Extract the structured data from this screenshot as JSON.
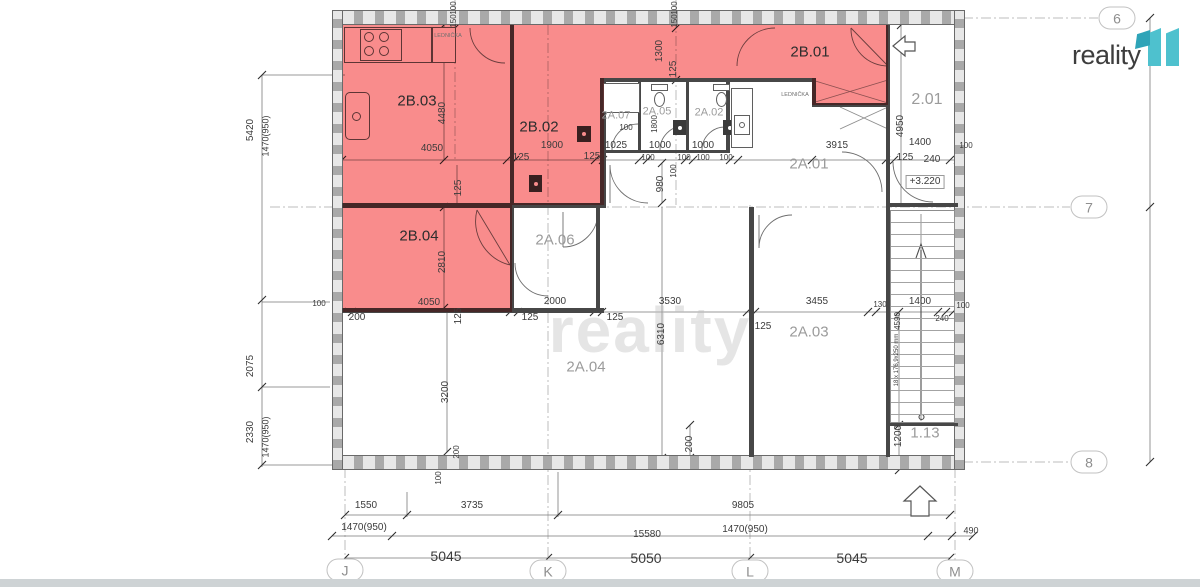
{
  "logo": {
    "brand": "reality",
    "mark": "11"
  },
  "watermark": {
    "text": "reality"
  },
  "colors": {
    "highlight_red": "#f98c8c",
    "logo_teal": "#4ec1ce",
    "logo_teal_dark": "#2ea4b8",
    "wall_gray": "#474747",
    "dim_text": "#3b3b3b",
    "room_label_gray": "#9b9b9b",
    "room_label_dark": "#2d2d2d"
  },
  "grid_markers": [
    {
      "label": "6",
      "x": 1117,
      "y": 18
    },
    {
      "label": "7",
      "x": 1089,
      "y": 207
    },
    {
      "label": "8",
      "x": 1089,
      "y": 462
    },
    {
      "label": "J",
      "x": 345,
      "y": 570
    },
    {
      "label": "K",
      "x": 548,
      "y": 571
    },
    {
      "label": "L",
      "x": 750,
      "y": 571
    },
    {
      "label": "M",
      "x": 955,
      "y": 571
    }
  ],
  "rooms": [
    {
      "id": "2B.03",
      "x": 417,
      "y": 101,
      "cls": "b"
    },
    {
      "id": "2B.02",
      "x": 539,
      "y": 127,
      "cls": "b"
    },
    {
      "id": "2B.01",
      "x": 810,
      "y": 52,
      "cls": "b"
    },
    {
      "id": "2B.04",
      "x": 419,
      "y": 236,
      "cls": "b"
    },
    {
      "id": "2A.07",
      "x": 616,
      "y": 116,
      "cls": "a",
      "s": 11
    },
    {
      "id": "2A.05",
      "x": 657,
      "y": 112,
      "cls": "a",
      "s": 11
    },
    {
      "id": "2A.02",
      "x": 709,
      "y": 113,
      "cls": "a",
      "s": 11
    },
    {
      "id": "2A.01",
      "x": 809,
      "y": 164,
      "cls": "a"
    },
    {
      "id": "2A.06",
      "x": 555,
      "y": 240,
      "cls": "a"
    },
    {
      "id": "2A.04",
      "x": 586,
      "y": 367,
      "cls": "a"
    },
    {
      "id": "2A.03",
      "x": 809,
      "y": 332,
      "cls": "a"
    },
    {
      "id": "2.01",
      "x": 927,
      "y": 100,
      "cls": "a",
      "s": 16
    },
    {
      "id": "1.13",
      "x": 925,
      "y": 433,
      "cls": "a"
    }
  ],
  "fixture_labels": [
    {
      "t": "LEDNIČKA",
      "x": 448,
      "y": 36
    },
    {
      "t": "LEDNIČKA",
      "x": 795,
      "y": 95
    }
  ],
  "dimensions": [
    {
      "t": "100",
      "x": 454,
      "y": 8,
      "r": -90,
      "s": 8
    },
    {
      "t": "150",
      "x": 454,
      "y": 21,
      "r": -90,
      "s": 8
    },
    {
      "t": "100",
      "x": 675,
      "y": 8,
      "r": -90,
      "s": 8
    },
    {
      "t": "150",
      "x": 675,
      "y": 21,
      "r": -90,
      "s": 8
    },
    {
      "t": "1300",
      "x": 660,
      "y": 51,
      "r": -90
    },
    {
      "t": "125",
      "x": 674,
      "y": 69,
      "r": -90
    },
    {
      "t": "4050",
      "x": 432,
      "y": 149
    },
    {
      "t": "4480",
      "x": 443,
      "y": 113,
      "r": -90
    },
    {
      "t": "125",
      "x": 521,
      "y": 158
    },
    {
      "t": "1900",
      "x": 552,
      "y": 146
    },
    {
      "t": "125",
      "x": 592,
      "y": 157
    },
    {
      "t": "1025",
      "x": 616,
      "y": 146
    },
    {
      "t": "100",
      "x": 626,
      "y": 128,
      "s": 8
    },
    {
      "t": "1800",
      "x": 655,
      "y": 124,
      "r": -90,
      "s": 8
    },
    {
      "t": "1000",
      "x": 660,
      "y": 146
    },
    {
      "t": "100",
      "x": 648,
      "y": 158,
      "s": 8
    },
    {
      "t": "1000",
      "x": 703,
      "y": 146
    },
    {
      "t": "100",
      "x": 684,
      "y": 158,
      "s": 8
    },
    {
      "t": "100",
      "x": 703,
      "y": 158,
      "s": 8
    },
    {
      "t": "100",
      "x": 726,
      "y": 158,
      "s": 8
    },
    {
      "t": "3915",
      "x": 837,
      "y": 146
    },
    {
      "t": "980",
      "x": 661,
      "y": 184,
      "r": -90
    },
    {
      "t": "100",
      "x": 674,
      "y": 171,
      "r": -90,
      "s": 8
    },
    {
      "t": "4950",
      "x": 901,
      "y": 126,
      "r": -90
    },
    {
      "t": "1400",
      "x": 920,
      "y": 143
    },
    {
      "t": "100",
      "x": 966,
      "y": 146,
      "s": 8
    },
    {
      "t": "125",
      "x": 905,
      "y": 158
    },
    {
      "t": "240",
      "x": 932,
      "y": 160
    },
    {
      "t": "+3.220",
      "x": 925,
      "y": 182,
      "box": true
    },
    {
      "t": "5420",
      "x": 251,
      "y": 130,
      "r": -90
    },
    {
      "t": "1470(950)",
      "x": 266,
      "y": 136,
      "r": -90,
      "s": 9
    },
    {
      "t": "2075",
      "x": 251,
      "y": 366,
      "r": -90
    },
    {
      "t": "2330",
      "x": 251,
      "y": 432,
      "r": -90
    },
    {
      "t": "1470(950)",
      "x": 266,
      "y": 437,
      "r": -90,
      "s": 9
    },
    {
      "t": "100",
      "x": 319,
      "y": 304,
      "s": 8
    },
    {
      "t": "200",
      "x": 357,
      "y": 318
    },
    {
      "t": "4050",
      "x": 429,
      "y": 303
    },
    {
      "t": "125",
      "x": 459,
      "y": 316,
      "r": -90
    },
    {
      "t": "125",
      "x": 530,
      "y": 318
    },
    {
      "t": "2000",
      "x": 555,
      "y": 302
    },
    {
      "t": "125",
      "x": 615,
      "y": 318
    },
    {
      "t": "3530",
      "x": 670,
      "y": 302
    },
    {
      "t": "6310",
      "x": 662,
      "y": 334,
      "r": -90
    },
    {
      "t": "125",
      "x": 763,
      "y": 327
    },
    {
      "t": "3455",
      "x": 817,
      "y": 302
    },
    {
      "t": "130",
      "x": 880,
      "y": 305,
      "s": 8
    },
    {
      "t": "1400",
      "x": 920,
      "y": 302
    },
    {
      "t": "4590",
      "x": 898,
      "y": 321,
      "r": -90,
      "s": 8
    },
    {
      "t": "240",
      "x": 942,
      "y": 319,
      "s": 8
    },
    {
      "t": "100",
      "x": 963,
      "y": 306,
      "s": 8
    },
    {
      "t": "125",
      "x": 459,
      "y": 188,
      "r": -90
    },
    {
      "t": "2810",
      "x": 443,
      "y": 262,
      "r": -90
    },
    {
      "t": "3200",
      "x": 446,
      "y": 392,
      "r": -90
    },
    {
      "t": "200",
      "x": 690,
      "y": 444,
      "r": -90
    },
    {
      "t": "1200",
      "x": 899,
      "y": 436,
      "r": -90
    },
    {
      "t": "200",
      "x": 457,
      "y": 452,
      "r": -90,
      "s": 8
    },
    {
      "t": "100",
      "x": 439,
      "y": 478,
      "r": -90,
      "s": 8
    },
    {
      "t": "18 x 176,9x250 mm",
      "x": 897,
      "y": 360,
      "r": -90,
      "s": 6
    },
    {
      "t": "1550",
      "x": 366,
      "y": 506
    },
    {
      "t": "3735",
      "x": 472,
      "y": 506
    },
    {
      "t": "9805",
      "x": 743,
      "y": 506
    },
    {
      "t": "1470(950)",
      "x": 364,
      "y": 528
    },
    {
      "t": "15580",
      "x": 647,
      "y": 535
    },
    {
      "t": "1470(950)",
      "x": 745,
      "y": 530
    },
    {
      "t": "490",
      "x": 971,
      "y": 531,
      "s": 9
    },
    {
      "t": "5045",
      "x": 446,
      "y": 556,
      "s": 14
    },
    {
      "t": "5050",
      "x": 646,
      "y": 558,
      "s": 14
    },
    {
      "t": "5045",
      "x": 852,
      "y": 558,
      "s": 14
    }
  ]
}
